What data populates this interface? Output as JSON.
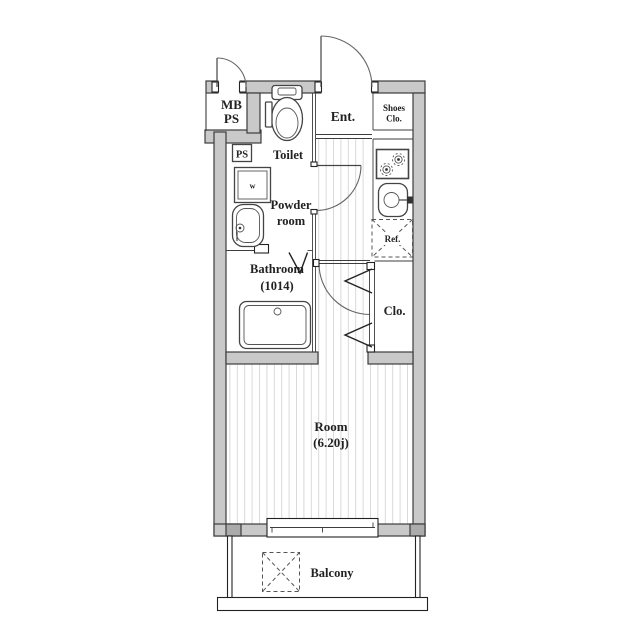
{
  "floorplan": {
    "labels": {
      "mb_ps_line1": "MB",
      "mb_ps_line2": "PS",
      "ps": "PS",
      "toilet": "Toilet",
      "entrance": "Ent.",
      "shoes_closet_line1": "Shoes",
      "shoes_closet_line2": "Clo.",
      "powder_room_line1": "Powder",
      "powder_room_line2": "room",
      "bathroom_line1": "Bathroom",
      "bathroom_size": "(1014)",
      "refrigerator": "Ref.",
      "closet": "Clo.",
      "room_line1": "Room",
      "room_size": "(6.20j)",
      "balcony": "Balcony",
      "washing_machine": "w"
    },
    "colors": {
      "wall_fill": "#c9c9c9",
      "wall_corner": "#ababab",
      "outline": "#3d3d3d",
      "floor_stripe": "#d9d9d9",
      "text": "#222222",
      "background": "#ffffff"
    }
  }
}
